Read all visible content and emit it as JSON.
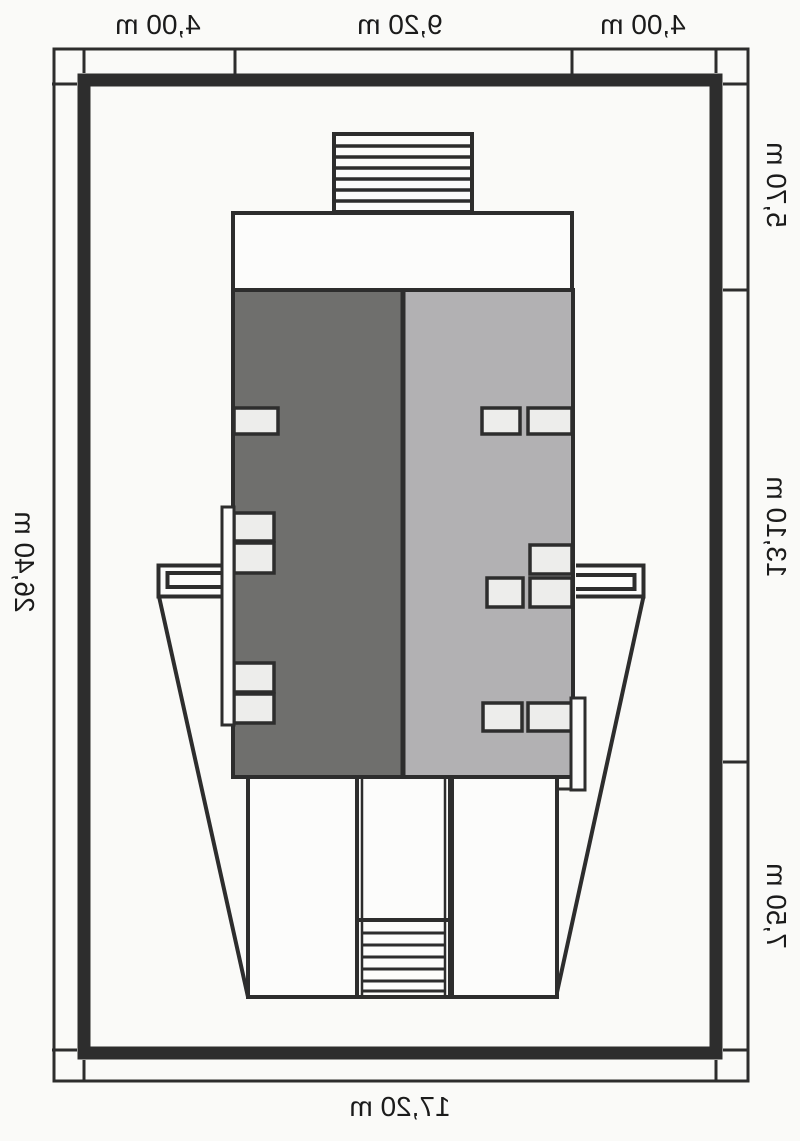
{
  "drawing": {
    "kind": "house site plan, mirrored presentation",
    "dimensions": {
      "top": [
        "4,00 m",
        "9,20 m",
        "4,00 m"
      ],
      "right": [
        "5,70 m",
        "13,10 m",
        "7,50 m"
      ],
      "left": [
        "26,40 m"
      ],
      "bottom": [
        "17,20 m"
      ]
    }
  },
  "colors": {
    "background": "#fafaf8",
    "paper": "#fcfcfb",
    "line": "#2d2d2d",
    "roof_dark": "#6f6f6d",
    "roof_light": "#b2b1b3",
    "window_fill": "#ededeb"
  }
}
